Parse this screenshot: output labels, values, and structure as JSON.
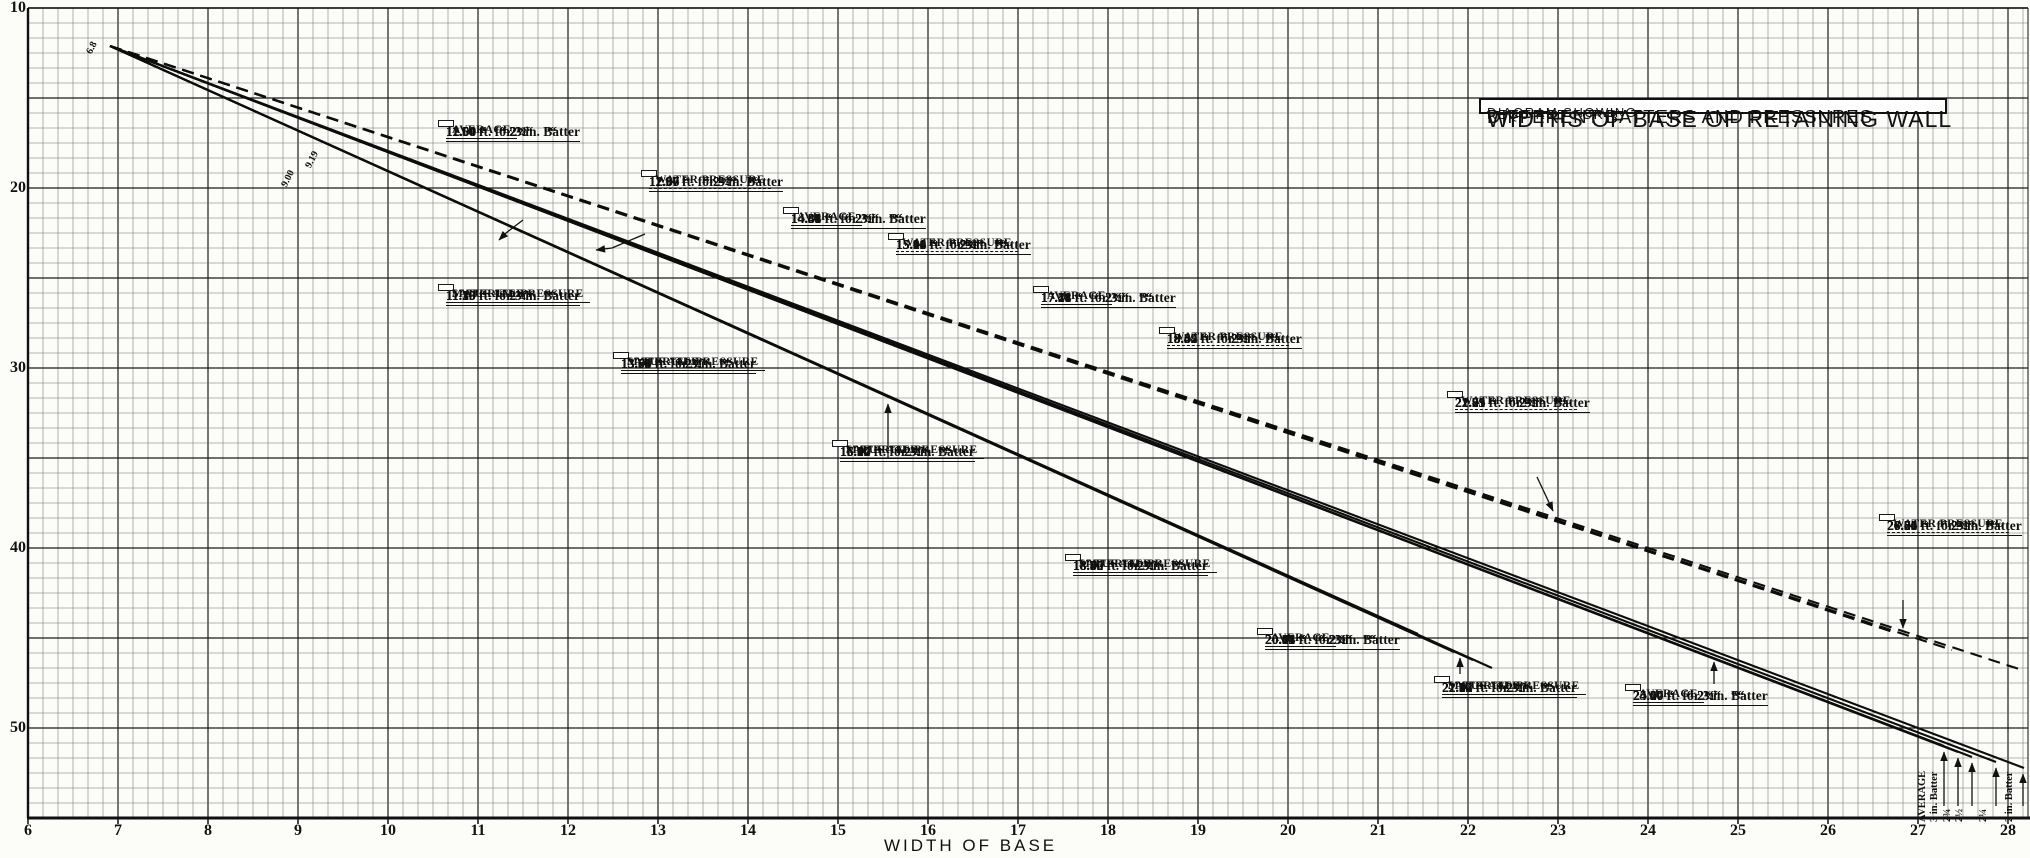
{
  "title_box": {
    "line1": "DIAGRAM SHOWING",
    "line2": "WIDTHS OF BASE OF RETAINING WALL",
    "line3": "REQUIRED FOR",
    "line4": "DIFFERENT BATTERS AND PRESSURES"
  },
  "axes": {
    "x_label": "WIDTH OF BASE",
    "y_label": "DEPTH BELOW CURB",
    "x_ticks": [
      "6",
      "7",
      "8",
      "9",
      "10",
      "11",
      "12",
      "13",
      "14",
      "15",
      "16",
      "17",
      "18",
      "19",
      "20",
      "21",
      "22",
      "23",
      "24",
      "25",
      "26",
      "27",
      "28"
    ],
    "y_ticks": [
      "10",
      "20",
      "30",
      "40",
      "50"
    ]
  },
  "inline_labels": [
    "6.8",
    "9.00",
    "9.19"
  ],
  "end_labels": [
    "AVERAGE",
    "3 in. Batter",
    "2¾",
    "2½",
    "2¼",
    "2 in. Batter"
  ],
  "annotation_boxes": [
    {
      "family": "average",
      "title": [
        "AVERAGE"
      ],
      "rows": [
        "11.56 ft. for 3 in. Batter",
        "11.60 “    “ 2¾“     “",
        "11.64 “    “ 2½“     “",
        "11.68 “    “ 2¼“     “",
        "12.00 “    “ 2 “     “"
      ]
    },
    {
      "family": "water-pressure",
      "title": [
        "WATER PRESSURE"
      ],
      "rows": [
        "11.97 ft. for 3 in. Batter",
        "12.00 “    “ 2¾“     “",
        "12.07 “    “ 2¼“     “",
        "12.66 “    “ 2 “     “"
      ]
    },
    {
      "family": "average",
      "title": [
        "AVERAGE"
      ],
      "rows": [
        "14.31 ft. for 3 in. Batter",
        "14.35 “    “ 2¾“     “",
        "14.41 “    “ 2½“     “",
        "14.48 “    “ 2¼“     “",
        "14.84 “    “ 2 “     “"
      ]
    },
    {
      "family": "water-pressure",
      "title": [
        "WATER PRESSURE"
      ],
      "rows": [
        "15.08 ft. for 3 in. Batter",
        "15.11 “    “ 2¾“     “",
        "15.16 “    “ 2½“     “",
        "15.24 “    “ 2¼“     “",
        "15.90 “    “ 2 “     “"
      ]
    },
    {
      "family": "average",
      "title": [
        "AVERAGE"
      ],
      "rows": [
        "17.14 ft. for 3 in. Batter",
        "17.21 “    “ 2¾“     “",
        "17.28 “    “ 2½“     “",
        "17.41 “    “ 2¼“     “",
        "17.78 “    “ 2 “     “"
      ]
    },
    {
      "family": "water-pressure",
      "title": [
        "WATER PRESSURE"
      ],
      "rows": [
        "18.34 ft. for 3 in. Batter",
        "18.42 “    “ 2¾“     “",
        "18.49 “    “ 2½“     “",
        "18.67 “    “ 2¼“     “",
        "19.34 “    “ 2 “     “"
      ]
    },
    {
      "family": "saturated",
      "title": [
        "SATURATED",
        "MATERIAL PRESSURE"
      ],
      "rows": [
        "11.15 ft. for 3 in. Batter",
        "11.20 “    “ 2¾“     “",
        "11.29 “    “ 2¼“     “",
        "11.35 “    “ 2 “     “"
      ]
    },
    {
      "family": "saturated",
      "title": [
        "SATURATED",
        "MATERIAL PRESSURE"
      ],
      "rows": [
        "13.54 ft. for 3 in. Batter",
        "13.59 “    “ 2¾“     “",
        "13.65 “    “ 2½“     “",
        "13.71 “    “ 2¼“     “",
        "13.78 “    “ 2 “     “"
      ]
    },
    {
      "family": "saturated",
      "title": [
        "SATURATED",
        "MATERIAL PRESSURE"
      ],
      "rows": [
        "15.94 ft. for 3 in. Batter",
        "16.00 “    “ 2¾“     “",
        "16.07 “    “ 2½“     “",
        "16.14 “    “ 2¼“     “",
        "16.22 “    “ 2 “     “"
      ]
    },
    {
      "family": "water-pressure",
      "title": [
        "WATER PRESSURE"
      ],
      "rows": [
        "21.73 ft. for 3 in. Batter",
        "21.81 “    “ 2¾“     “",
        "21.91 “    “ 2½“     “",
        "22.25 “    “ 2¼“     “",
        "22.79 “    “ 2 “     “"
      ]
    },
    {
      "family": "saturated",
      "title": [
        "SATURATED",
        "MATERIAL PRESSURE"
      ],
      "rows": [
        "18.35 ft. for 3 in. Batter",
        "18.42 “    “ 2¾“     “",
        "18.50 “    “ 2½“     “",
        "18.60 “    “ 2¼“     “",
        "18.70 “    “ 2 “     “"
      ]
    },
    {
      "family": "average",
      "title": [
        "AVERAGE"
      ],
      "rows": [
        "20.04 ft. for 3 in. Batter",
        "20.11 “    “ 2¾“     “",
        "20.21 “    “ 2½“     “",
        "20.43 “    “ 2¼“     “",
        "20.75 “    “ 2 “     “"
      ]
    },
    {
      "family": "saturated",
      "title": [
        "SATURATED",
        "MATERIAL PRESSURE"
      ],
      "rows": [
        "21.84 ft. for 3 in. Batter",
        "21.93 “    “ 2¾“     “",
        "22.02 “    “ 2½“     “",
        "22.12 “    “ 2¼“     “",
        "22.22 “    “ 2 “     “"
      ]
    },
    {
      "family": "average",
      "title": [
        "AVERAGE"
      ],
      "rows": [
        "24.20 ft. for 3 in. Batter",
        "24.30 “    “ 2¾“     “",
        "24.40 “    “ 2½“     “",
        "24.67 “    “ 2¼“     “",
        "25.00 “    “ 2 “     “"
      ]
    },
    {
      "family": "water-pressure",
      "title": [
        "WATER PRESSURE"
      ],
      "rows": [
        "26.56 ft. for 3 in. Batter",
        "26.66 “    “ 2¾“     “",
        "26.80 “    “ 2½“     “",
        "27.21 “    “ 2¼“     “",
        "27.75 “    “ 2 “     “"
      ]
    }
  ],
  "chart_data": {
    "type": "line",
    "title": "WIDTHS OF BASE OF RETAINING WALL REQUIRED FOR DIFFERENT BATTERS AND PRESSURES",
    "xlabel": "WIDTH OF BASE",
    "ylabel": "DEPTH BELOW CURB",
    "x_range": [
      6,
      28
    ],
    "y_range_depth": [
      10,
      55
    ],
    "y_axis_inverted": true,
    "grid": true,
    "common_origin_width_label": "6.8",
    "batters": [
      "3 in.",
      "2¾ in.",
      "2½ in.",
      "2¼ in.",
      "2 in."
    ],
    "families": [
      {
        "name": "AVERAGE",
        "line_style": "solid",
        "width_groups": [
          [
            11.56,
            11.6,
            11.64,
            11.68,
            12.0
          ],
          [
            14.31,
            14.35,
            14.41,
            14.48,
            14.84
          ],
          [
            17.14,
            17.21,
            17.28,
            17.41,
            17.78
          ],
          [
            20.04,
            20.11,
            20.21,
            20.43,
            20.75
          ],
          [
            24.2,
            24.3,
            24.4,
            24.67,
            25.0
          ]
        ]
      },
      {
        "name": "WATER PRESSURE",
        "line_style": "dashed",
        "width_groups": [
          [
            11.97,
            12.0,
            12.07,
            12.66
          ],
          [
            15.08,
            15.11,
            15.16,
            15.24,
            15.9
          ],
          [
            18.34,
            18.42,
            18.49,
            18.67,
            19.34
          ],
          [
            21.73,
            21.81,
            21.91,
            22.25,
            22.79
          ],
          [
            26.56,
            26.66,
            26.8,
            27.21,
            27.75
          ]
        ]
      },
      {
        "name": "SATURATED MATERIAL PRESSURE",
        "line_style": "solid",
        "width_groups": [
          [
            11.15,
            11.2,
            11.29,
            11.35
          ],
          [
            13.54,
            13.59,
            13.65,
            13.71,
            13.78
          ],
          [
            15.94,
            16.0,
            16.07,
            16.14,
            16.22
          ],
          [
            18.35,
            18.42,
            18.5,
            18.6,
            18.7
          ],
          [
            21.84,
            21.93,
            22.02,
            22.12,
            22.22
          ]
        ]
      }
    ],
    "ink_color": "#111111",
    "paper_color": "#fcfcf9"
  }
}
